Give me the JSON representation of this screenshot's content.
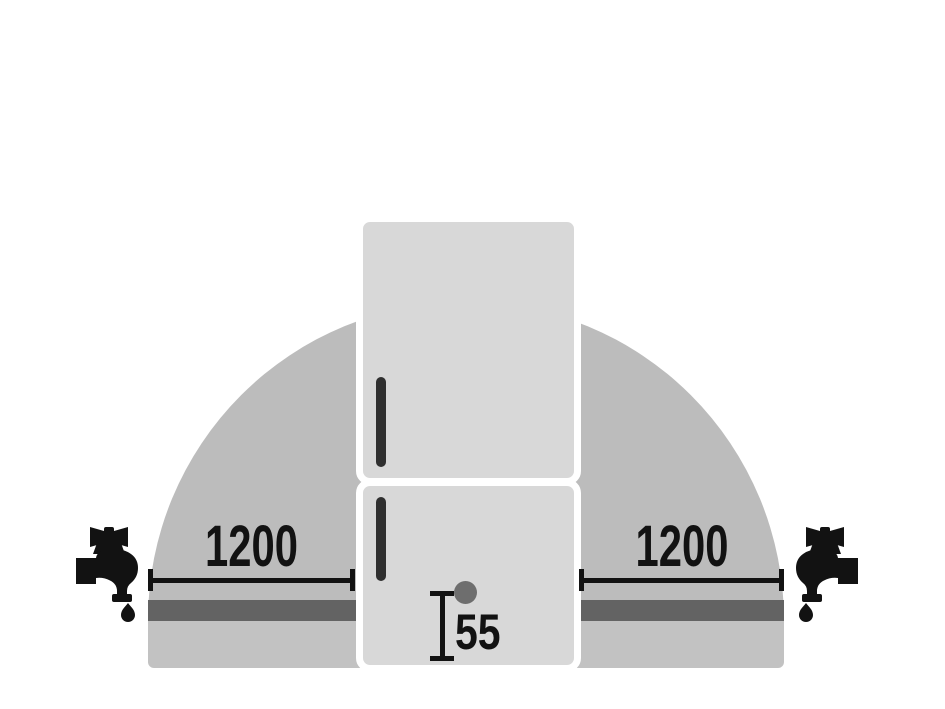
{
  "colors": {
    "background": "#ffffff",
    "dome_fill": "#bcbcbc",
    "base_fill": "#c2c2c2",
    "stripe_fill": "#636363",
    "fridge_fill": "#d8d8d8",
    "outline": "#ffffff",
    "handle_fill": "#2f2f2f",
    "dot_fill": "#6e6e6e",
    "ink": "#121212"
  },
  "dimensions": {
    "left_clearance": {
      "label": "1200"
    },
    "right_clearance": {
      "label": "1200"
    },
    "inlet_height": {
      "label": "55"
    }
  },
  "icons": {
    "left_tap": "water-tap-icon",
    "right_tap": "water-tap-icon"
  }
}
